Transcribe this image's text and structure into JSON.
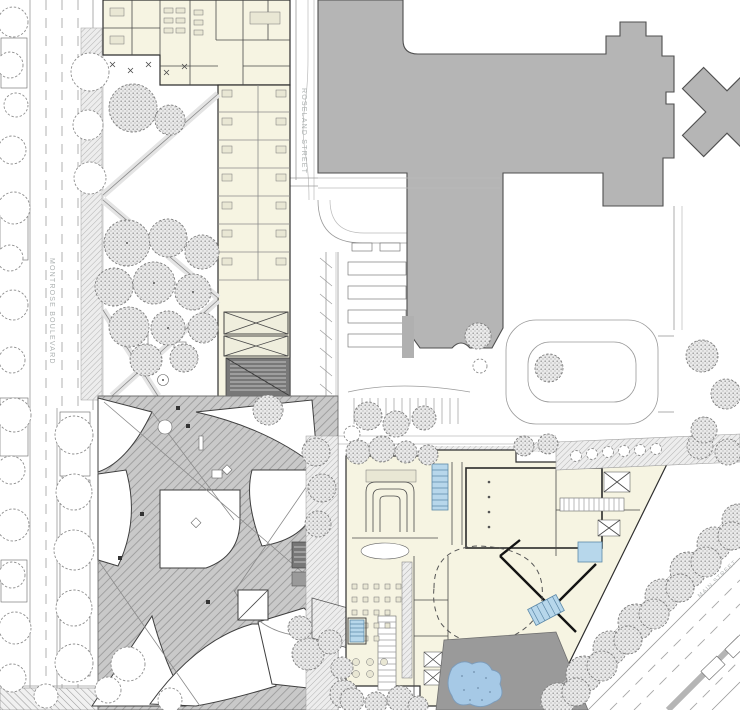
{
  "labels": {
    "street_left": "MONTROSE BOULEVARD",
    "street_middle": "ROSELAND STREET",
    "street_diagonal": "MAIN STREET"
  },
  "colors": {
    "existing_building": "#b5b5b5",
    "new_building_fill": "#f6f4e2",
    "water_pool": "#a6c9e6",
    "terrace": "#9a9a9a",
    "plaza_hatch": "#c9c9c9",
    "street_label": "#abb0b0"
  }
}
